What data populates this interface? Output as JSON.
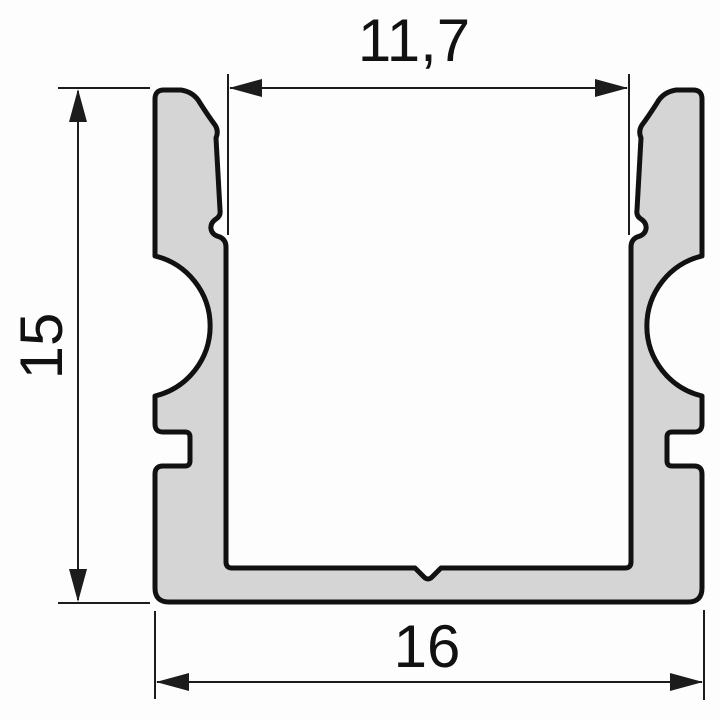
{
  "drawing": {
    "kind": "profile-cross-section",
    "dimensions": {
      "inner_width": {
        "label": "11,7",
        "value": 11.7,
        "orientation": "horizontal",
        "position": "top"
      },
      "height": {
        "label": "15",
        "value": 15,
        "orientation": "vertical",
        "position": "left"
      },
      "outer_width": {
        "label": "16",
        "value": 16,
        "orientation": "horizontal",
        "position": "bottom"
      }
    }
  },
  "colors": {
    "background": "#fdfdfd",
    "profile_fill": "#d5d5d5",
    "profile_outline": "#111111",
    "dimension_line": "#1c1c1c",
    "dimension_text": "#111111"
  }
}
